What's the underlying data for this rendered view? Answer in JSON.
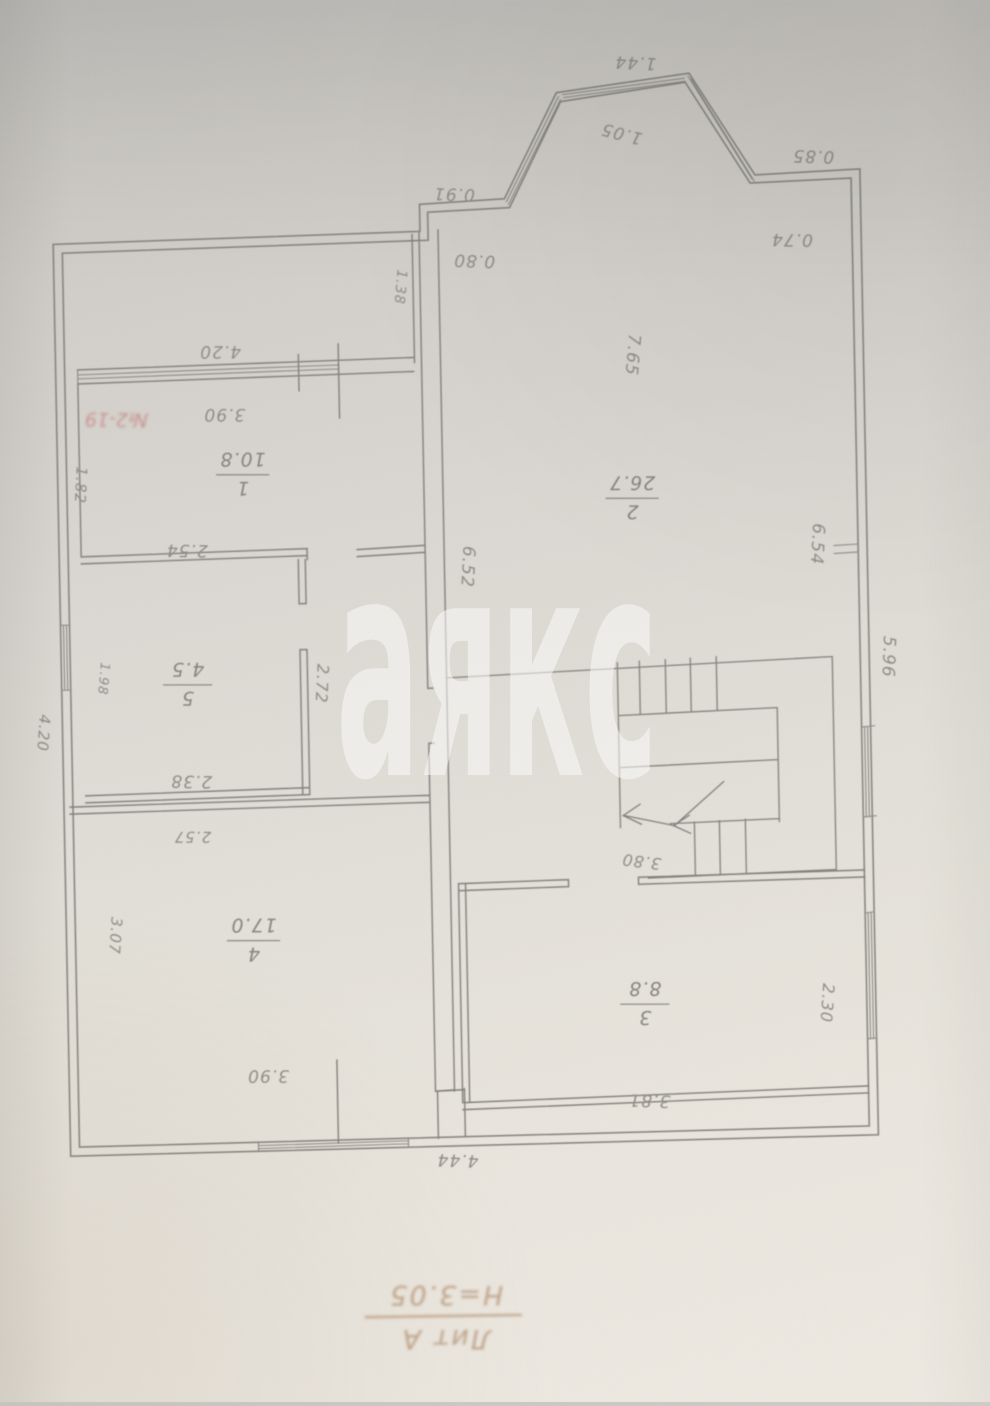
{
  "watermark": {
    "text": "аякс"
  },
  "stamp": {
    "text": "№2-19"
  },
  "title_block": {
    "litera": "Лит А",
    "height_note": "Н=3.05"
  },
  "rooms": [
    {
      "number": "1",
      "area": "10.8"
    },
    {
      "number": "2",
      "area": "26.7"
    },
    {
      "number": "3",
      "area": "8.8"
    },
    {
      "number": "4",
      "area": "17.0"
    },
    {
      "number": "5",
      "area": "4.5"
    }
  ],
  "dims": {
    "d144": "1.44",
    "d105": "1.05",
    "d085": "0.85",
    "d074": "0.74",
    "d091": "0.91",
    "d080": "0.80",
    "d138": "1.38",
    "d420_top": "4.20",
    "d390_top": "3.90",
    "d182": "1.82",
    "d254": "2.54",
    "d765": "7.65",
    "d652": "6.52",
    "d654": "6.54",
    "d596": "5.96",
    "d272": "2.72",
    "d238": "2.38",
    "d198": "1.98",
    "d420_left": "4.20",
    "d257": "2.57",
    "d307": "3.07",
    "d390_bottom": "3.90",
    "d444": "4.44",
    "d380_stairs": "3.80",
    "d381": "3.81",
    "d230": "2.30"
  }
}
